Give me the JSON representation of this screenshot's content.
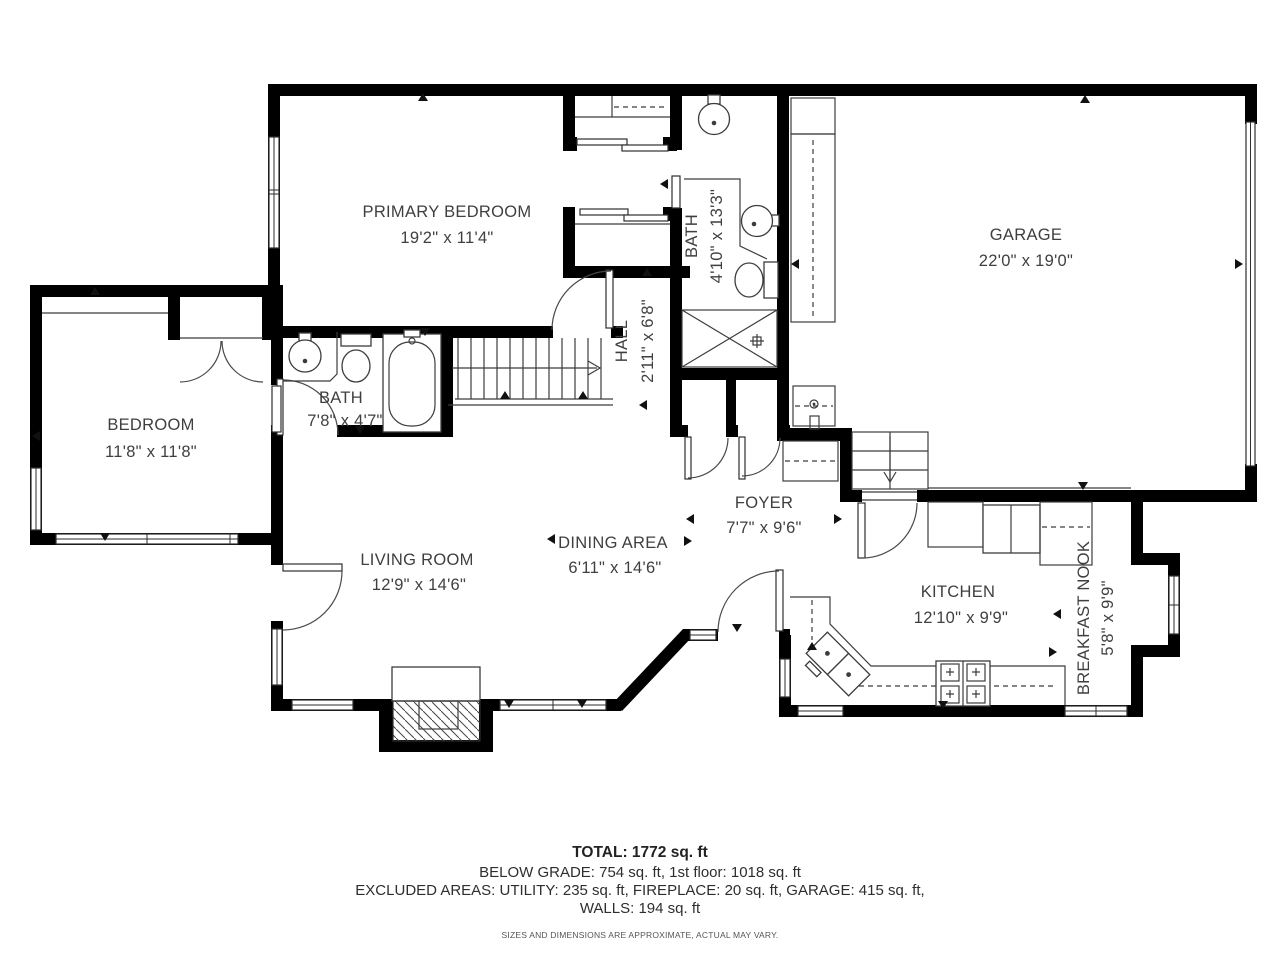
{
  "colors": {
    "wall": "#000000",
    "line": "#3c3c3c",
    "text": "#3f3f3f",
    "background": "#ffffff"
  },
  "rooms": {
    "primary_bedroom": {
      "name": "PRIMARY BEDROOM",
      "dims": "19'2\" x 11'4\""
    },
    "bath_upper": {
      "name": "BATH",
      "dims": "4'10\" x 13'3\""
    },
    "garage": {
      "name": "GARAGE",
      "dims": "22'0\" x 19'0\""
    },
    "hall": {
      "name": "HALL",
      "dims": "2'11\" x 6'8\""
    },
    "bath_main": {
      "name": "BATH",
      "dims": "7'8\" x 4'7\""
    },
    "bedroom": {
      "name": "BEDROOM",
      "dims": "11'8\" x 11'8\""
    },
    "foyer": {
      "name": "FOYER",
      "dims": "7'7\" x 9'6\""
    },
    "living_room": {
      "name": "LIVING ROOM",
      "dims": "12'9\" x 14'6\""
    },
    "dining_area": {
      "name": "DINING AREA",
      "dims": "6'11\" x 14'6\""
    },
    "kitchen": {
      "name": "KITCHEN",
      "dims": "12'10\" x 9'9\""
    },
    "breakfast_nook": {
      "name": "BREAKFAST NOOK",
      "dims": "5'8\" x 9'9\""
    }
  },
  "summary": {
    "total": "TOTAL: 1772 sq. ft",
    "below_grade": "BELOW GRADE: 754 sq. ft, 1st floor: 1018 sq. ft",
    "excluded": "EXCLUDED AREAS: UTILITY: 235 sq. ft, FIREPLACE: 20 sq. ft, GARAGE: 415 sq. ft,",
    "walls": "WALLS: 194 sq. ft",
    "disclaimer": "SIZES AND DIMENSIONS ARE APPROXIMATE, ACTUAL MAY VARY."
  }
}
